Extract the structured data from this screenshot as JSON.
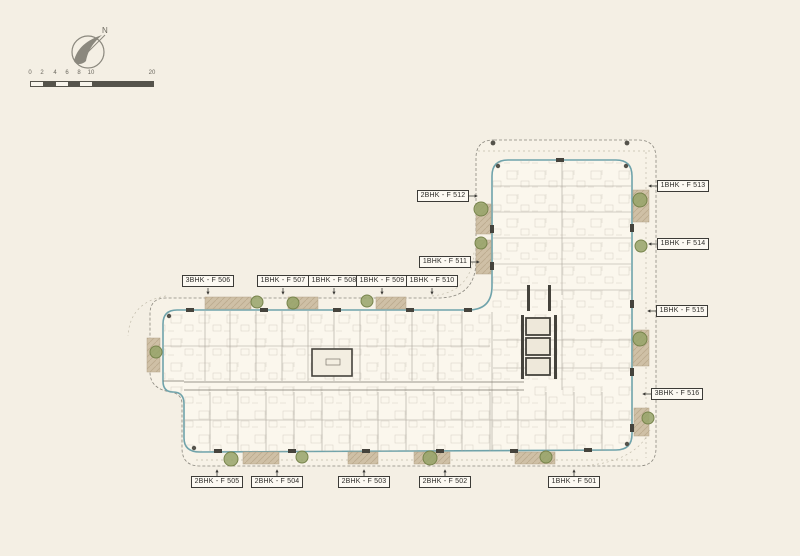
{
  "compass": {
    "label": "N"
  },
  "scalebar": {
    "ticks": [
      "0",
      "2",
      "4",
      "6",
      "8",
      "10",
      "20"
    ]
  },
  "plan": {
    "labels": [
      {
        "id": "f512",
        "text": "2BHK - F 512"
      },
      {
        "id": "f513",
        "text": "1BHK - F 513"
      },
      {
        "id": "f514",
        "text": "1BHK - F 514"
      },
      {
        "id": "f511",
        "text": "1BHK - F 511"
      },
      {
        "id": "f506",
        "text": "3BHK - F 506"
      },
      {
        "id": "f507",
        "text": "1BHK - F 507"
      },
      {
        "id": "f508",
        "text": "1BHK - F 508"
      },
      {
        "id": "f509",
        "text": "1BHK - F 509"
      },
      {
        "id": "f510",
        "text": "1BHK - F 510"
      },
      {
        "id": "f515",
        "text": "1BHK - F 515"
      },
      {
        "id": "f516",
        "text": "3BHK - F 516"
      },
      {
        "id": "f505",
        "text": "2BHK - F 505"
      },
      {
        "id": "f504",
        "text": "2BHK - F 504"
      },
      {
        "id": "f503",
        "text": "2BHK - F 503"
      },
      {
        "id": "f502",
        "text": "2BHK - F 502"
      },
      {
        "id": "f501",
        "text": "1BHK - F 501"
      }
    ],
    "colors": {
      "background": "#f4efe4",
      "building_edge": "#6fa3ab",
      "balcony": "#cfc0a6",
      "tree": "#96a368",
      "wall_dark": "#45433c"
    }
  }
}
